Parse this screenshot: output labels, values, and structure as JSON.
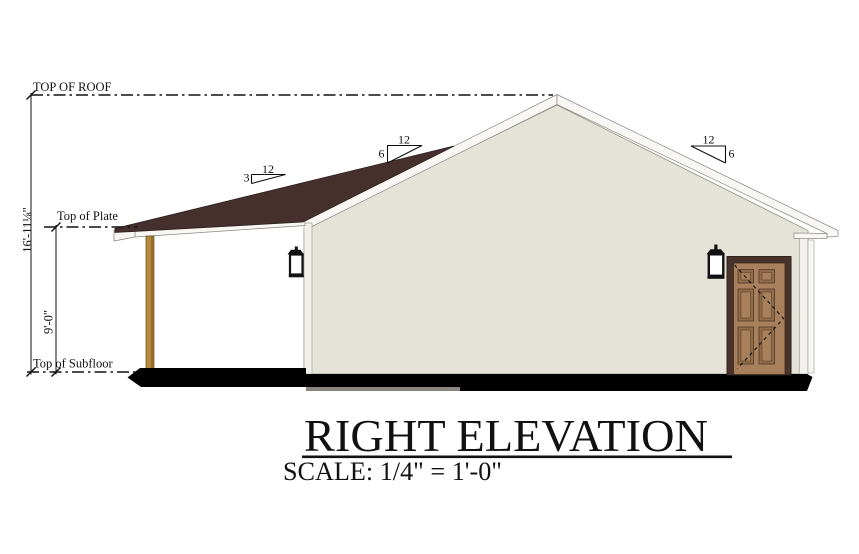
{
  "drawing": {
    "title": "RIGHT ELEVATION",
    "scale_label": "SCALE: 1/4\" = 1'-0\"",
    "levels": {
      "top_of_roof": "TOP OF ROOF",
      "top_of_plate": "Top of Plate",
      "top_of_subfloor": "Top of Subfloor"
    },
    "dimensions": {
      "overall_height": "16'-11⅛\"",
      "wall_height": "9'-0\""
    },
    "pitches": [
      {
        "id": "porch-roof",
        "rise": "3",
        "run": "12"
      },
      {
        "id": "main-roof-left",
        "rise": "6",
        "run": "12"
      },
      {
        "id": "main-roof-right",
        "rise": "6",
        "run": "12"
      }
    ],
    "colors": {
      "roof_brown": "#46302e",
      "wall_cream": "#e5e3d9",
      "trim_white": "#f8f7f4",
      "corner_trim": "#f1f0ea",
      "post_tan": "#b5893e",
      "post_shadow": "#8f6c2f",
      "door_frame_brown": "#4a332b",
      "door_slab_brown": "#a8805b",
      "door_panel_brown": "#916c48",
      "foundation_black": "#000000",
      "footing_gray": "#8b867f"
    }
  }
}
